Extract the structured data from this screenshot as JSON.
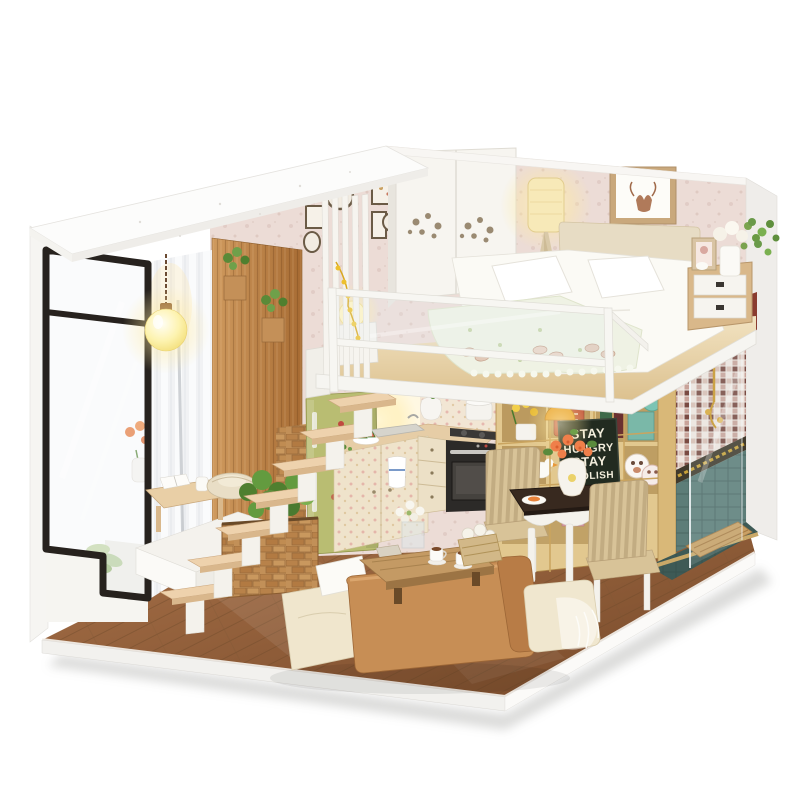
{
  "scene": {
    "description": "Photo of a handcrafted DIY miniature dollhouse: a loft apartment with glass corner window, wooden staircase, kitchen with green fridge, bookshelf, dining set, leather sofa, mosaic-tiled shower room and a white loft bedroom with railing, all lit by warm miniature lamps on a white background.",
    "background": "#ffffff"
  },
  "poster": {
    "lines": [
      "STAY",
      "HUNGRY",
      "STAY",
      "FOOLISH"
    ]
  },
  "colors": {
    "background": "#ffffff",
    "wallpaper": "#ecdcd6",
    "roof": "#fcfcfb",
    "left_wall": "#f6f5f2",
    "right_wall": "#efedea",
    "curtain": "#f2f3f5",
    "wood_wall": "#c08448",
    "window_frame": "#27221e",
    "loft_floor": "#ecd9b4",
    "railing": "#f7f6f2",
    "fascia": "#f6f5f1",
    "bed": "#fbfaf5",
    "headboard": "#e7dcc4",
    "blanket": "#eff2e4",
    "wardrobe": "#f7f5f0",
    "lamp_glow": "#ffeaa0",
    "fridge": "#b9bd72",
    "cabinet": "#efe3cb",
    "counter": "#e6cda6",
    "oven": "#2c2a28",
    "shelf": "#e2c88f",
    "poster_bg": "#222b20",
    "poster_text": "#f3eedd",
    "table_top": "#38291f",
    "chair_fabric": "#d8c398",
    "sofa": "#c78e55",
    "ottoman": "#f0e6cd",
    "coffee_table": "#c49a64",
    "floor_wood": "#9a6640",
    "stairs": "#eed2ad",
    "plant": "#5f8f3d",
    "mosaic_base": "#c9a39a",
    "bath_tile": "#5d7d78",
    "bath_floor": "#3e5a56",
    "gold_fixture": "#c9962a",
    "teal_vase": "#7cc4b4",
    "rose_orange": "#ef7f4a"
  }
}
